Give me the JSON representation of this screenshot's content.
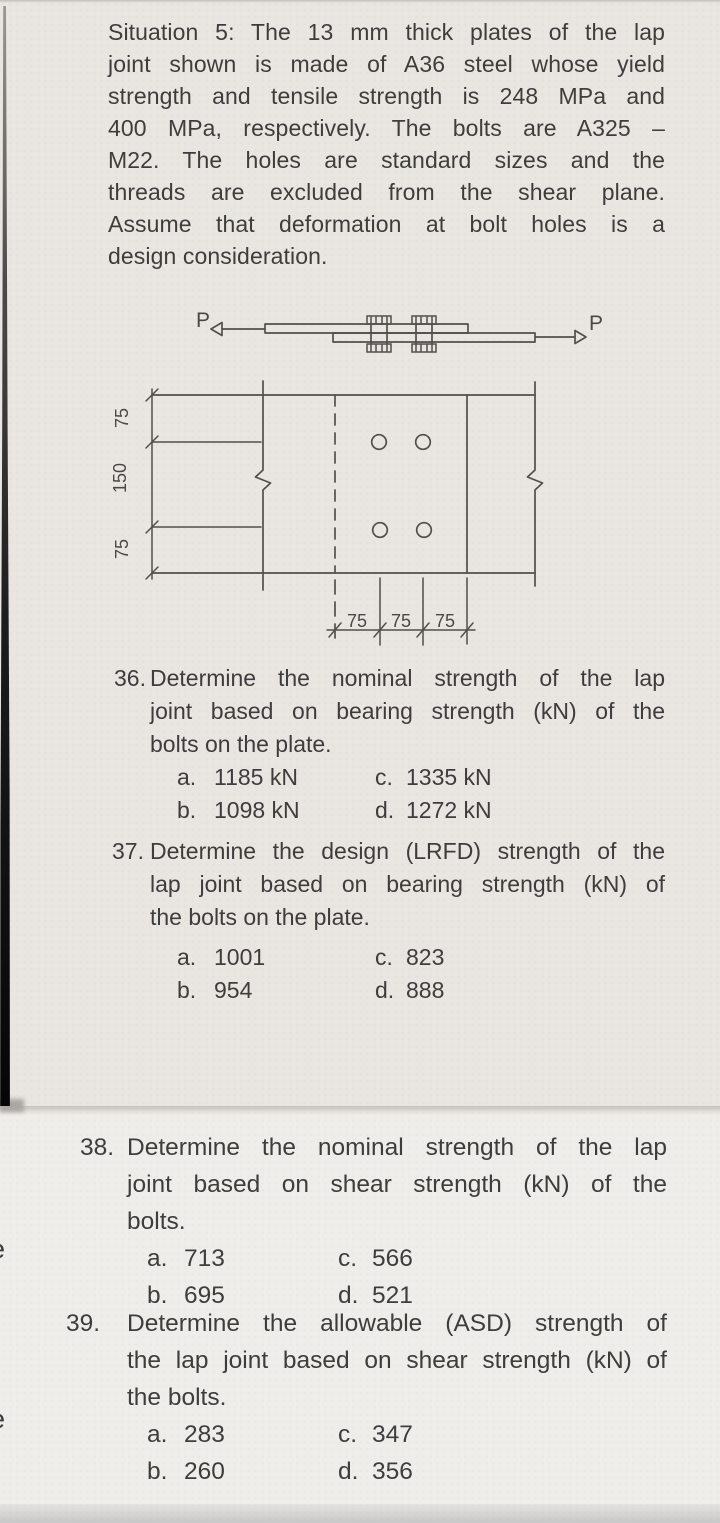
{
  "situation": {
    "lines": [
      "Situation 5: The 13 mm thick plates of the lap",
      "joint shown is made of A36 steel whose yield",
      "strength and tensile strength is 248 MPa and",
      "400 MPa, respectively. The bolts are A325 –",
      "M22. The holes are standard sizes and the",
      "threads are excluded from the shear plane.",
      "Assume that deformation at bolt holes is a",
      "design consideration."
    ]
  },
  "diagram": {
    "load_left": "P",
    "load_right": "P",
    "dims_vertical": [
      "75",
      "150",
      "75"
    ],
    "dims_horizontal": [
      "75",
      "75",
      "75"
    ]
  },
  "questions": [
    {
      "number": "36.",
      "lines": [
        "Determine the nominal strength of the lap",
        "joint based on bearing strength (kN) of the",
        "bolts on the plate."
      ],
      "choices": [
        {
          "label": "a.",
          "value": "1185 kN"
        },
        {
          "label": "b.",
          "value": "1098 kN"
        },
        {
          "label": "c.",
          "value": "1335 kN"
        },
        {
          "label": "d.",
          "value": "1272 kN"
        }
      ]
    },
    {
      "number": "37.",
      "lines": [
        "Determine the design (LRFD) strength of the",
        "lap joint based on bearing strength (kN) of",
        "the bolts on the plate."
      ],
      "choices": [
        {
          "label": "a.",
          "value": "1001"
        },
        {
          "label": "b.",
          "value": "954"
        },
        {
          "label": "c.",
          "value": "823"
        },
        {
          "label": "d.",
          "value": "888"
        }
      ]
    },
    {
      "number": "38.",
      "lines": [
        "Determine the nominal strength of the lap",
        "joint based on shear strength (kN) of the",
        "bolts."
      ],
      "choices": [
        {
          "label": "a.",
          "value": "713"
        },
        {
          "label": "b.",
          "value": "695"
        },
        {
          "label": "c.",
          "value": "566"
        },
        {
          "label": "d.",
          "value": "521"
        }
      ]
    },
    {
      "number": "39.",
      "lines": [
        "Determine the allowable (ASD) strength of",
        "the lap joint based on shear strength (kN) of",
        "the bolts."
      ],
      "choices": [
        {
          "label": "a.",
          "value": "283"
        },
        {
          "label": "b.",
          "value": "260"
        },
        {
          "label": "c.",
          "value": "347"
        },
        {
          "label": "d.",
          "value": "356"
        }
      ]
    }
  ],
  "artifacts": {
    "fragments": [
      "e",
      "e"
    ]
  }
}
